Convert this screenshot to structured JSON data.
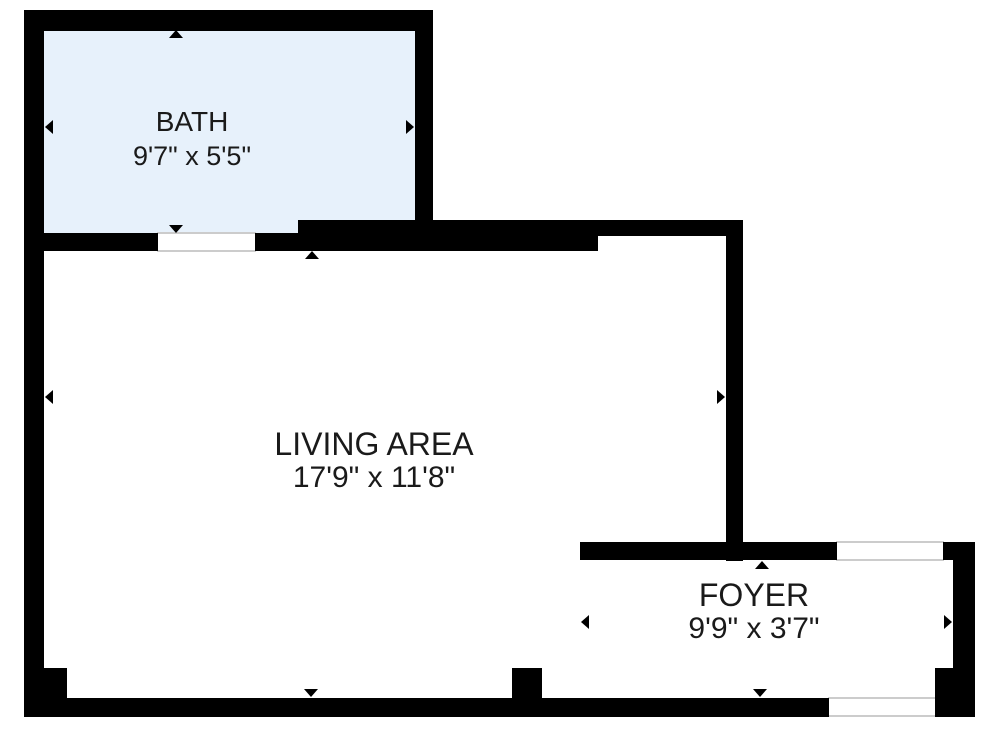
{
  "floorplan": {
    "rooms": [
      {
        "id": "bath",
        "name": "BATH",
        "dimensions": "9'7\" x 5'5\""
      },
      {
        "id": "living-area",
        "name": "LIVING AREA",
        "dimensions": "17'9\" x 11'8\""
      },
      {
        "id": "foyer",
        "name": "FOYER",
        "dimensions": "9'9\" x 3'7\""
      }
    ],
    "colors": {
      "wall": "#000000",
      "bath_fill": "#e7f1fb",
      "background": "#ffffff",
      "opening_outline": "#cccccc",
      "text": "#1a1a1a"
    }
  }
}
